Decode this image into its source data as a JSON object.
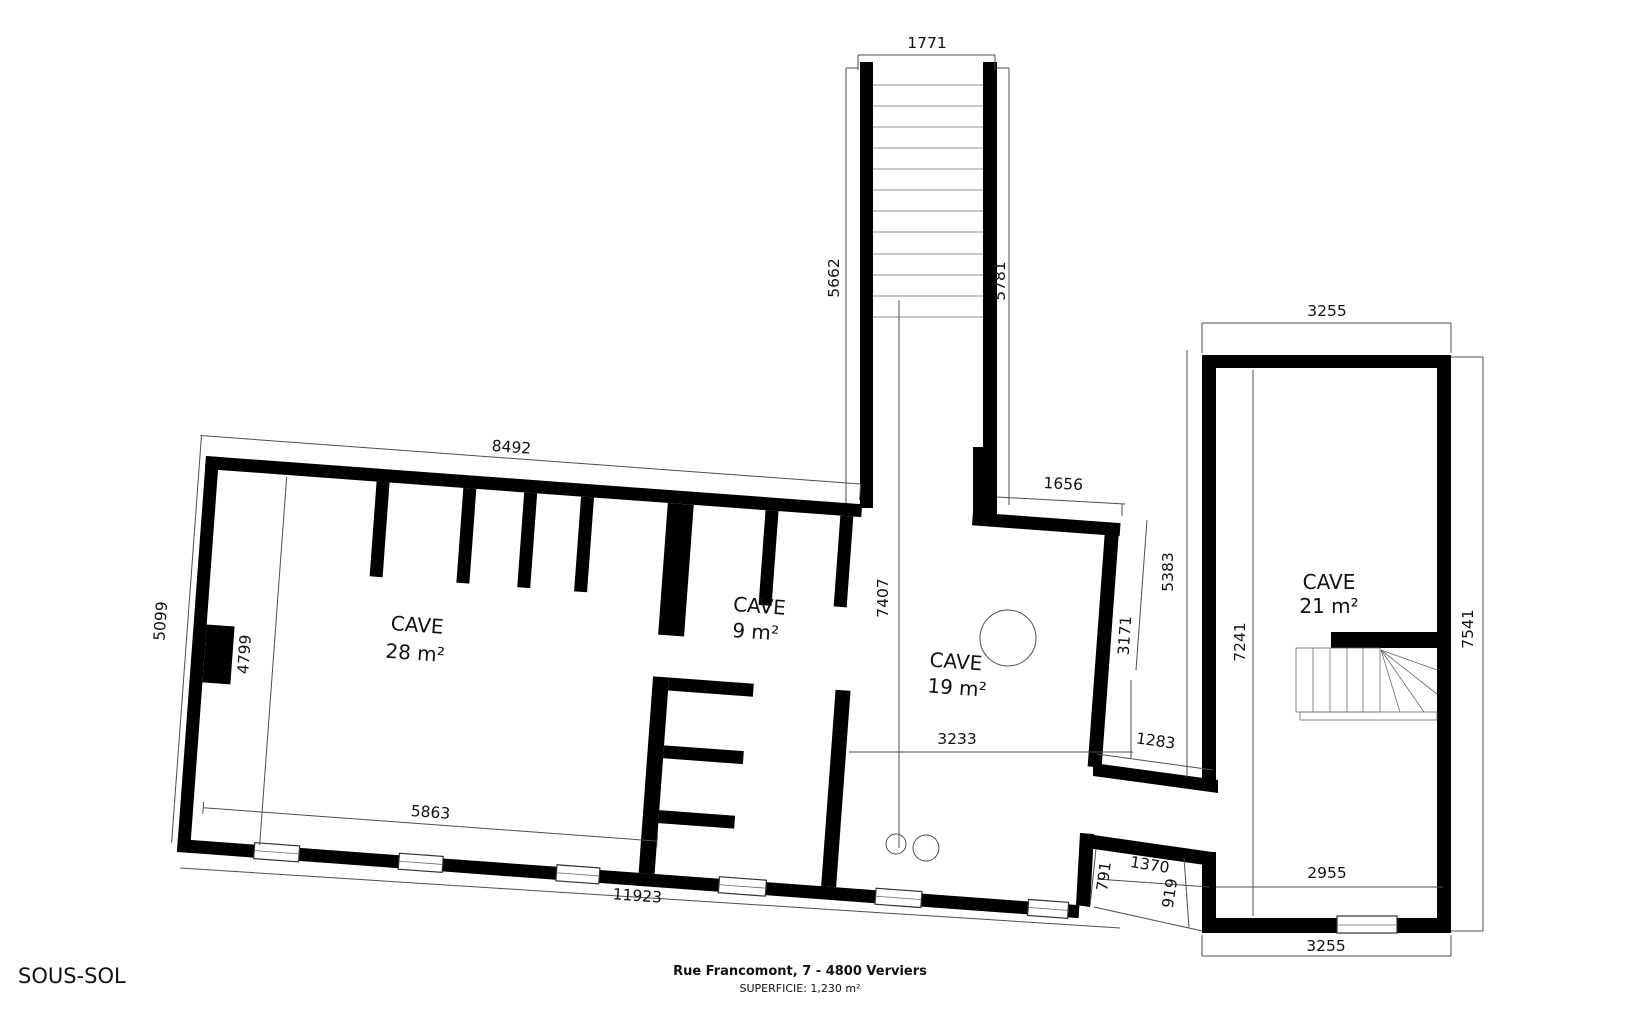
{
  "page": {
    "floor_label": "SOUS-SOL",
    "address": "Rue Francomont, 7 - 4800 Verviers",
    "area_total": "SUPERFICIE: 1,230 m²"
  },
  "rooms": [
    {
      "name": "CAVE",
      "area": "28 m²"
    },
    {
      "name": "CAVE",
      "area": "9 m²"
    },
    {
      "name": "CAVE",
      "area": "19 m²"
    },
    {
      "name": "CAVE",
      "area": "21 m²"
    }
  ],
  "dims": {
    "stair_top_width": "1771",
    "stair_left_height": "5662",
    "stair_right_height": "5781",
    "main_top_width": "8492",
    "cave19_top_opening": "1656",
    "right_block_top_width": "3255",
    "right_gap_height": "5383",
    "passage_right_height": "3171",
    "stair_to_bottom": "7407",
    "right_block_inner_height": "7241",
    "right_block_outer_height": "7541",
    "main_left_outer_height": "5099",
    "main_left_inner_height": "4799",
    "cave19_width": "3233",
    "passage_width": "1283",
    "main_bottom_inner_width": "5863",
    "main_bottom_outer_width": "11923",
    "door_main_opening": "791",
    "corridor_length": "1370",
    "door_right_opening": "919",
    "right_block_bottom_inner_width": "2955",
    "right_block_bottom_outer_width": "3255"
  },
  "colors": {
    "wall": "#000000",
    "dimline": "#4d4d4d",
    "text": "#111111",
    "background": "#ffffff"
  }
}
